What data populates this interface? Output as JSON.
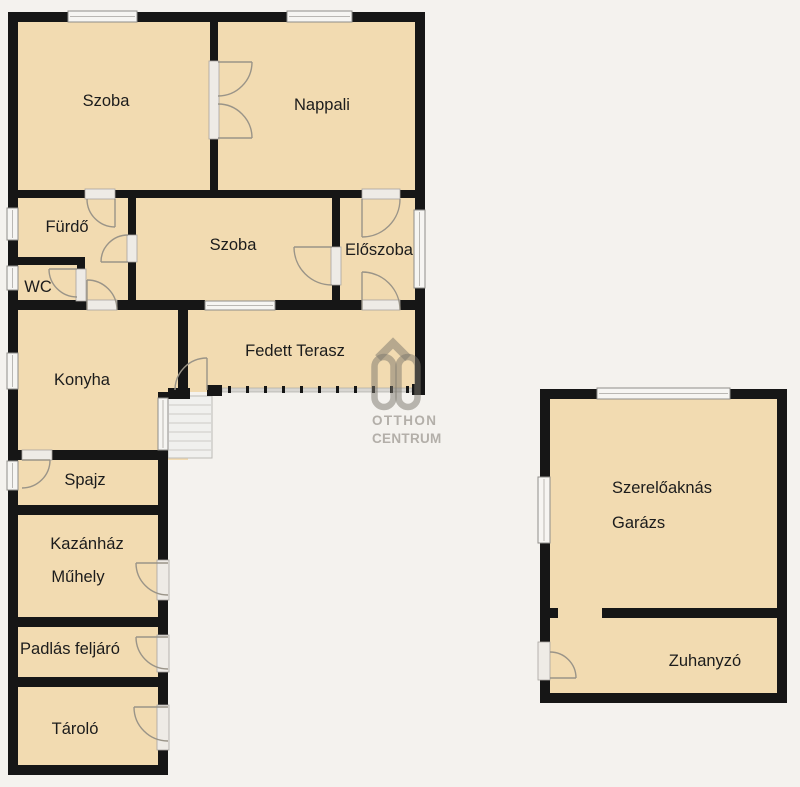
{
  "plan": {
    "type": "floor-plan",
    "colors": {
      "background": "#f4f2ee",
      "room_fill": "#f2dbb1",
      "wall": "#161616",
      "window_fill": "#f6f5f2",
      "window_frame": "#8f8d89",
      "door_opening_fill": "#eeebe6",
      "door_swing": "#9a9488",
      "stairs_fill": "#f0f0ee",
      "terrace_edge": "#d8d6d2",
      "label_text": "#1c1c1c",
      "watermark": "#b3afa9"
    },
    "rooms": [
      {
        "id": "szoba-1",
        "label": "Szoba"
      },
      {
        "id": "nappali",
        "label": "Nappali"
      },
      {
        "id": "furdo",
        "label": "Fürdő"
      },
      {
        "id": "szoba-2",
        "label": "Szoba"
      },
      {
        "id": "eloszoba",
        "label": "Előszoba"
      },
      {
        "id": "wc",
        "label": "WC"
      },
      {
        "id": "konyha",
        "label": "Konyha"
      },
      {
        "id": "fedett-terasz",
        "label": "Fedett Terasz"
      },
      {
        "id": "spajz",
        "label": "Spajz"
      },
      {
        "id": "kazanhaz",
        "label": "Kazánház"
      },
      {
        "id": "muhely",
        "label": "Műhely"
      },
      {
        "id": "padlas-feljaro",
        "label": "Padlás feljáró"
      },
      {
        "id": "tarolo",
        "label": "Tároló"
      },
      {
        "id": "garazs",
        "lines": [
          "Szerelőaknás",
          "Garázs"
        ]
      },
      {
        "id": "zuhanyzo",
        "label": "Zuhanyzó"
      }
    ],
    "watermark": {
      "logo": "otthon-centrum-house-logo",
      "line1": "OTTHON",
      "line2": "CENTRUM"
    }
  }
}
